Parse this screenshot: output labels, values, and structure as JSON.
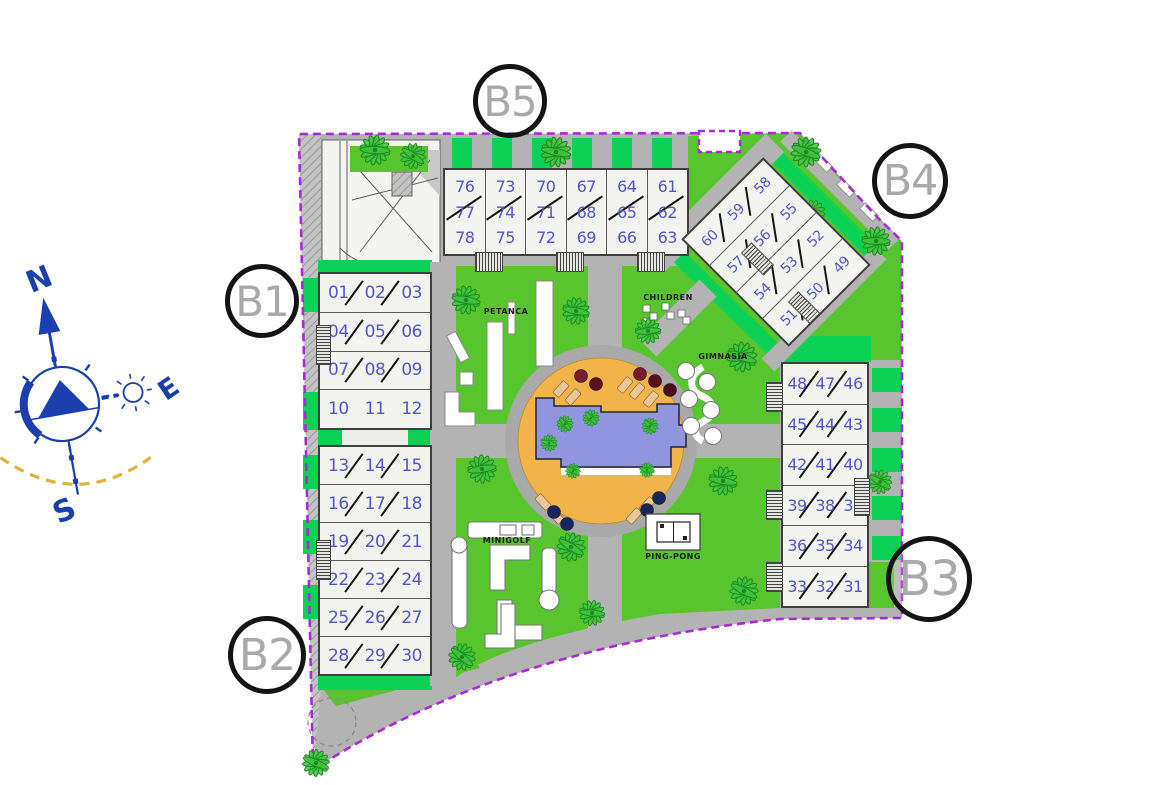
{
  "site": {
    "buildings": {
      "b5": {
        "label": "B5",
        "columns": [
          [
            "76",
            "77",
            "78"
          ],
          [
            "73",
            "74",
            "75"
          ],
          [
            "70",
            "71",
            "72"
          ],
          [
            "67",
            "68",
            "69"
          ],
          [
            "64",
            "65",
            "66"
          ],
          [
            "61",
            "62",
            "63"
          ]
        ]
      },
      "b1": {
        "label": "B1",
        "rows": [
          [
            "01",
            "02",
            "03"
          ],
          [
            "04",
            "05",
            "06"
          ],
          [
            "07",
            "08",
            "09"
          ],
          [
            "10",
            "11",
            "12"
          ]
        ],
        "no_slash_rows": [
          3
        ]
      },
      "b2": {
        "label": "B2",
        "rows": [
          [
            "13",
            "14",
            "15"
          ],
          [
            "16",
            "17",
            "18"
          ],
          [
            "19",
            "20",
            "21"
          ],
          [
            "22",
            "23",
            "24"
          ],
          [
            "25",
            "26",
            "27"
          ],
          [
            "28",
            "29",
            "30"
          ]
        ],
        "no_slash_rows": []
      },
      "b3": {
        "label": "B3",
        "rows": [
          [
            "48",
            "47",
            "46"
          ],
          [
            "45",
            "44",
            "43"
          ],
          [
            "42",
            "41",
            "40"
          ],
          [
            "39",
            "38",
            "37"
          ],
          [
            "36",
            "35",
            "34"
          ],
          [
            "33",
            "32",
            "31"
          ]
        ],
        "no_slash_rows": []
      },
      "b4": {
        "label": "B4",
        "rows": [
          [
            "60",
            "59",
            "58"
          ],
          [
            "57",
            "56",
            "55"
          ],
          [
            "54",
            "53",
            "52"
          ],
          [
            "51",
            "50",
            "49"
          ]
        ],
        "no_slash_rows": []
      }
    },
    "amenities": {
      "petanca": "PETANCA",
      "children": "CHILDREN",
      "gimnasia": "GIMNASIA",
      "minigolf": "MINIGOLF",
      "pingpong": "PING-PONG"
    },
    "compass": {
      "north": "N",
      "east": "E",
      "south": "S"
    },
    "vegetation": {
      "palms": [
        {
          "x": 375,
          "y": 150,
          "s": 1
        },
        {
          "x": 413,
          "y": 156,
          "s": 0.85
        },
        {
          "x": 556,
          "y": 152,
          "s": 1
        },
        {
          "x": 806,
          "y": 152,
          "s": 1
        },
        {
          "x": 813,
          "y": 212,
          "s": 0.8
        },
        {
          "x": 876,
          "y": 241,
          "s": 0.95
        },
        {
          "x": 466,
          "y": 300,
          "s": 0.95
        },
        {
          "x": 576,
          "y": 311,
          "s": 0.9
        },
        {
          "x": 648,
          "y": 331,
          "s": 0.85
        },
        {
          "x": 742,
          "y": 357,
          "s": 1
        },
        {
          "x": 482,
          "y": 469,
          "s": 0.95
        },
        {
          "x": 723,
          "y": 481,
          "s": 0.95
        },
        {
          "x": 571,
          "y": 547,
          "s": 0.95
        },
        {
          "x": 592,
          "y": 613,
          "s": 0.85
        },
        {
          "x": 744,
          "y": 591,
          "s": 0.95
        },
        {
          "x": 462,
          "y": 657,
          "s": 0.9
        },
        {
          "x": 316,
          "y": 763,
          "s": 0.9
        },
        {
          "x": 880,
          "y": 482,
          "s": 0.8
        },
        {
          "x": 565,
          "y": 424,
          "s": 0.55
        },
        {
          "x": 591,
          "y": 418,
          "s": 0.55
        },
        {
          "x": 549,
          "y": 443,
          "s": 0.55
        },
        {
          "x": 650,
          "y": 426,
          "s": 0.55
        },
        {
          "x": 573,
          "y": 471,
          "s": 0.5
        },
        {
          "x": 647,
          "y": 470,
          "s": 0.5
        }
      ]
    },
    "colors": {
      "lawn": "#58c52e",
      "hedge": "#0bd154",
      "road": "#b3b3b3",
      "boundary": "#a92ad6",
      "pool_water": "#9195e0",
      "pool_deck": "#f2b44a",
      "unit_number": "#5356c9",
      "compass_blue": "#1b3fae",
      "sun_arc": "#e3b23a"
    }
  }
}
